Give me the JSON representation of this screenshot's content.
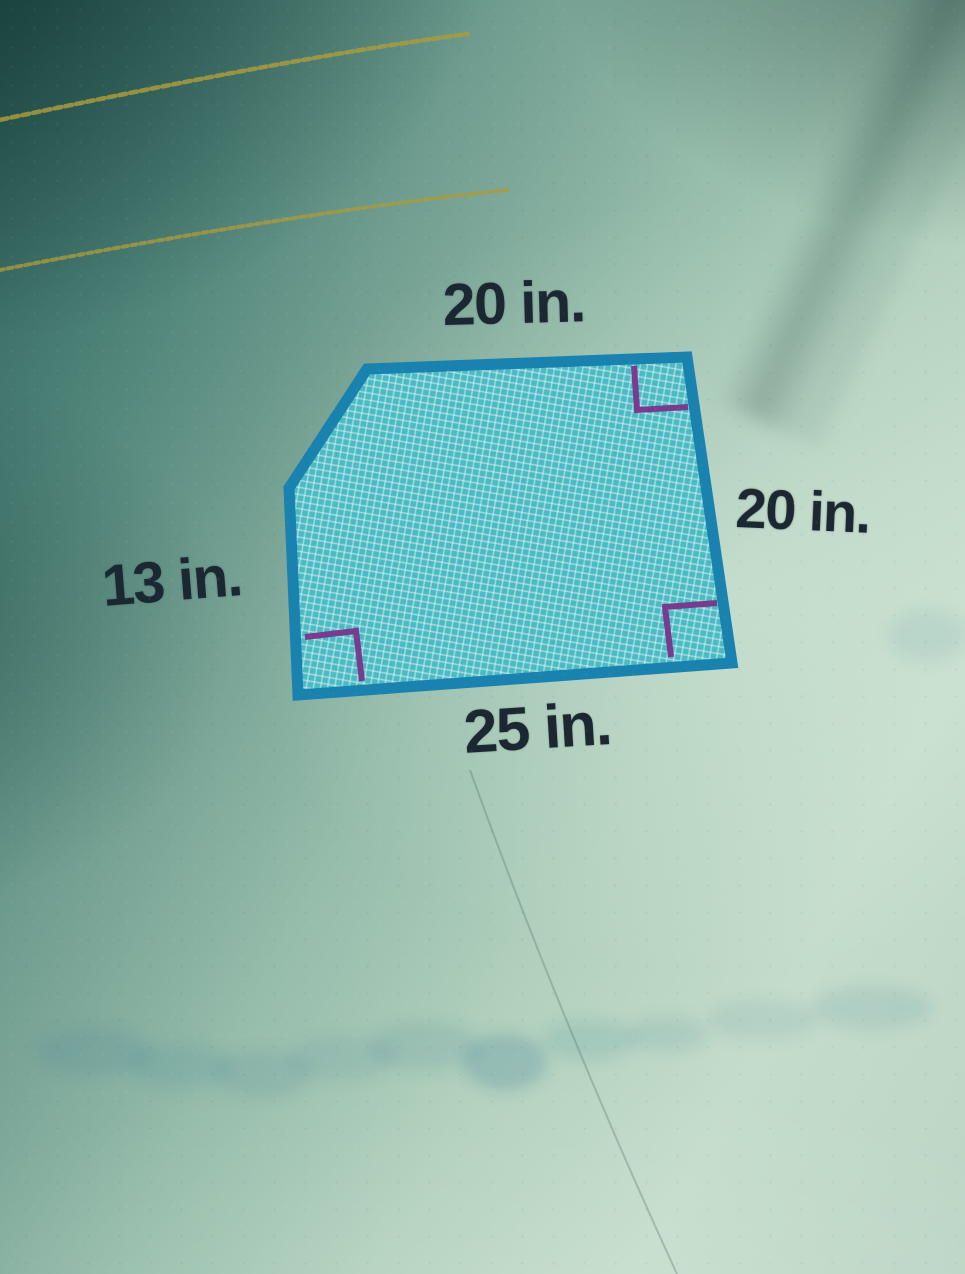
{
  "figure": {
    "type": "geometry-diagram",
    "labels": {
      "top": "20 in.",
      "right": "20 in.",
      "left": "13 in.",
      "bottom": "25 in."
    },
    "polygon_points": "367,369 687,357 732,663 298,695 289,488",
    "outline_color": "#1a82ae",
    "fill_color": "#4cbac4",
    "mesh_line_color": "#eafcf8",
    "right_angle_marker_color": "#793b8e",
    "label_color": "#1b2831",
    "right_angle_markers": {
      "top_right": "634,366 637,410 688,407",
      "bottom_right": "717,603 665,607 671,657",
      "bottom_left": "305,637 356,631 362,681"
    }
  },
  "page": {
    "rule_line_color": "#a89b3e",
    "rule_line_1_path": "M -10,122 C 150,88 330,52 468,34",
    "rule_line_2_path": "M -10,272 C 160,238 360,205 508,190",
    "scratch_line_path": "M 470,770 Q 560,1020 677,1274"
  }
}
